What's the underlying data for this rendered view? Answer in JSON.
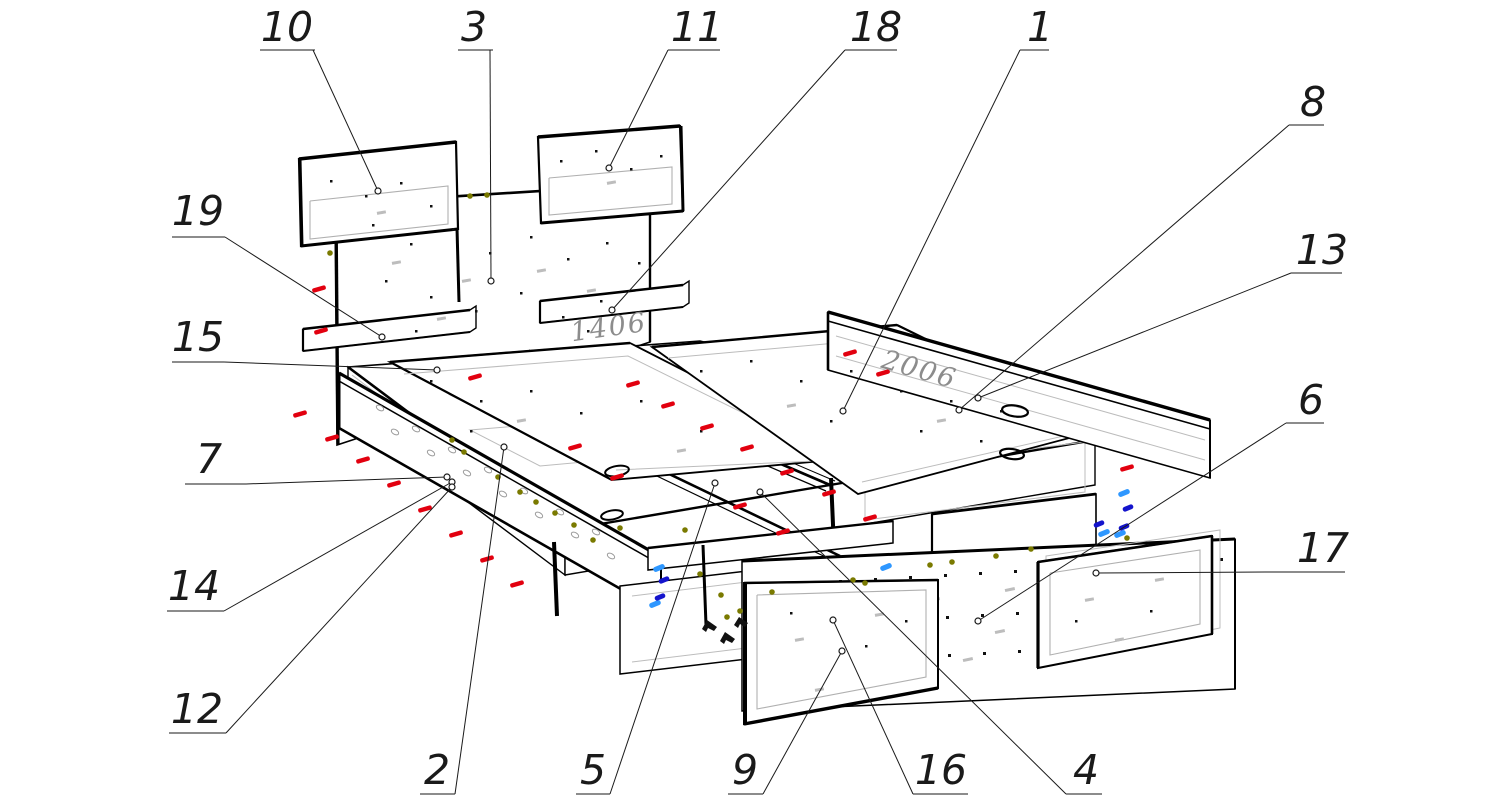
{
  "figure": {
    "title": "exploded-assembly-drawing-bed-with-drawers",
    "background": "#ffffff",
    "line_color": "#1a1a1a",
    "part_count": 19
  },
  "dimensions": [
    {
      "text": "1406",
      "x": 610,
      "y": 336,
      "rotate": -8
    },
    {
      "text": "2006",
      "x": 917,
      "y": 378,
      "rotate": 16
    }
  ],
  "callouts": [
    {
      "label": "10",
      "tx": 287,
      "ty": 26,
      "ex1": 260,
      "ex2": 315,
      "ey": 50,
      "lx": 313,
      "ly": 50,
      "px": 378,
      "py": 191
    },
    {
      "label": "3",
      "tx": 474,
      "ty": 26,
      "ex1": 458,
      "ex2": 493,
      "ey": 50,
      "lx": 490,
      "ly": 50,
      "px": 491,
      "py": 281
    },
    {
      "label": "11",
      "tx": 697,
      "ty": 26,
      "ex1": 668,
      "ex2": 720,
      "ey": 50,
      "lx": 668,
      "ly": 50,
      "px": 609,
      "py": 168
    },
    {
      "label": "18",
      "tx": 876,
      "ty": 26,
      "ex1": 845,
      "ex2": 897,
      "ey": 50,
      "lx": 845,
      "ly": 50,
      "px": 612,
      "py": 310
    },
    {
      "label": "1",
      "tx": 1040,
      "ty": 26,
      "ex1": 1020,
      "ex2": 1049,
      "ey": 50,
      "lx": 1020,
      "ly": 50,
      "px": 843,
      "py": 411
    },
    {
      "label": "8",
      "tx": 1313,
      "ty": 101,
      "ex1": 1289,
      "ex2": 1324,
      "ey": 125,
      "lx": 1289,
      "ly": 125,
      "px": 959,
      "py": 410
    },
    {
      "label": "13",
      "tx": 1322,
      "ty": 249,
      "ex1": 1291,
      "ex2": 1342,
      "ey": 273,
      "lx": 1291,
      "ly": 273,
      "px": 978,
      "py": 398
    },
    {
      "label": "6",
      "tx": 1311,
      "ty": 399,
      "ex1": 1286,
      "ex2": 1324,
      "ey": 423,
      "lx": 1286,
      "ly": 423,
      "px": 978,
      "py": 621
    },
    {
      "label": "17",
      "tx": 1323,
      "ty": 547,
      "ex1": 1265,
      "ex2": 1345,
      "ey": 572,
      "lx": 1265,
      "ly": 572,
      "px": 1096,
      "py": 573
    },
    {
      "label": "19",
      "tx": 198,
      "ty": 210,
      "ex1": 172,
      "ex2": 225,
      "ey": 237,
      "lx": 225,
      "ly": 237,
      "px": 382,
      "py": 337
    },
    {
      "label": "15",
      "tx": 198,
      "ty": 336,
      "ex1": 172,
      "ex2": 224,
      "ey": 362,
      "lx": 224,
      "ly": 362,
      "px": 437,
      "py": 370
    },
    {
      "label": "7",
      "tx": 209,
      "ty": 458,
      "ex1": 185,
      "ex2": 246,
      "ey": 484,
      "lx": 246,
      "ly": 484,
      "px": 447,
      "py": 477
    },
    {
      "label": "14",
      "tx": 194,
      "ty": 585,
      "ex1": 167,
      "ex2": 224,
      "ey": 611,
      "lx": 224,
      "ly": 611,
      "px": 452,
      "py": 482
    },
    {
      "label": "12",
      "tx": 197,
      "ty": 708,
      "ex1": 169,
      "ex2": 226,
      "ey": 733,
      "lx": 226,
      "ly": 733,
      "px": 452,
      "py": 487
    },
    {
      "label": "2",
      "tx": 437,
      "ty": 769,
      "ex1": 420,
      "ex2": 455,
      "ey": 794,
      "lx": 455,
      "ly": 794,
      "px": 504,
      "py": 447
    },
    {
      "label": "5",
      "tx": 593,
      "ty": 769,
      "ex1": 576,
      "ex2": 610,
      "ey": 794,
      "lx": 610,
      "ly": 794,
      "px": 715,
      "py": 483
    },
    {
      "label": "9",
      "tx": 745,
      "ty": 769,
      "ex1": 728,
      "ex2": 763,
      "ey": 794,
      "lx": 763,
      "ly": 794,
      "px": 842,
      "py": 651
    },
    {
      "label": "16",
      "tx": 941,
      "ty": 769,
      "ex1": 913,
      "ex2": 968,
      "ey": 794,
      "lx": 913,
      "ly": 794,
      "px": 833,
      "py": 620
    },
    {
      "label": "4",
      "tx": 1086,
      "ty": 769,
      "ex1": 1066,
      "ex2": 1102,
      "ey": 794,
      "lx": 1066,
      "ly": 794,
      "px": 760,
      "py": 492
    }
  ],
  "fasteners": {
    "red": {
      "color": "#e2000f",
      "marks": [
        [
          319,
          289
        ],
        [
          321,
          331
        ],
        [
          300,
          414
        ],
        [
          332,
          438
        ],
        [
          363,
          460
        ],
        [
          394,
          484
        ],
        [
          425,
          509
        ],
        [
          456,
          534
        ],
        [
          487,
          559
        ],
        [
          517,
          584
        ],
        [
          475,
          377
        ],
        [
          575,
          447
        ],
        [
          617,
          477
        ],
        [
          633,
          384
        ],
        [
          668,
          405
        ],
        [
          707,
          427
        ],
        [
          747,
          448
        ],
        [
          787,
          472
        ],
        [
          829,
          493
        ],
        [
          870,
          518
        ],
        [
          740,
          506
        ],
        [
          783,
          532
        ],
        [
          850,
          353
        ],
        [
          883,
          373
        ],
        [
          1127,
          468
        ]
      ]
    },
    "blue_light": {
      "color": "#2e97ff",
      "marks": [
        [
          659,
          568
        ],
        [
          655,
          604
        ],
        [
          886,
          567
        ],
        [
          1124,
          493
        ],
        [
          1120,
          534
        ],
        [
          1104,
          533
        ]
      ]
    },
    "blue_dark": {
      "color": "#1414cc",
      "marks": [
        [
          664,
          580
        ],
        [
          660,
          597
        ],
        [
          1128,
          508
        ],
        [
          1124,
          527
        ],
        [
          1099,
          524
        ]
      ]
    },
    "olive": {
      "color": "#7a7a00",
      "marks": [
        [
          470,
          196
        ],
        [
          487,
          195
        ],
        [
          330,
          253
        ],
        [
          452,
          440
        ],
        [
          464,
          452
        ],
        [
          498,
          477
        ],
        [
          520,
          492
        ],
        [
          536,
          502
        ],
        [
          555,
          513
        ],
        [
          574,
          525
        ],
        [
          593,
          540
        ],
        [
          685,
          530
        ],
        [
          721,
          595
        ],
        [
          740,
          611
        ],
        [
          727,
          617
        ],
        [
          772,
          592
        ],
        [
          853,
          580
        ],
        [
          930,
          565
        ],
        [
          952,
          562
        ],
        [
          996,
          556
        ],
        [
          1031,
          549
        ],
        [
          1127,
          538
        ],
        [
          865,
          583
        ],
        [
          620,
          528
        ],
        [
          700,
          574
        ]
      ]
    }
  }
}
